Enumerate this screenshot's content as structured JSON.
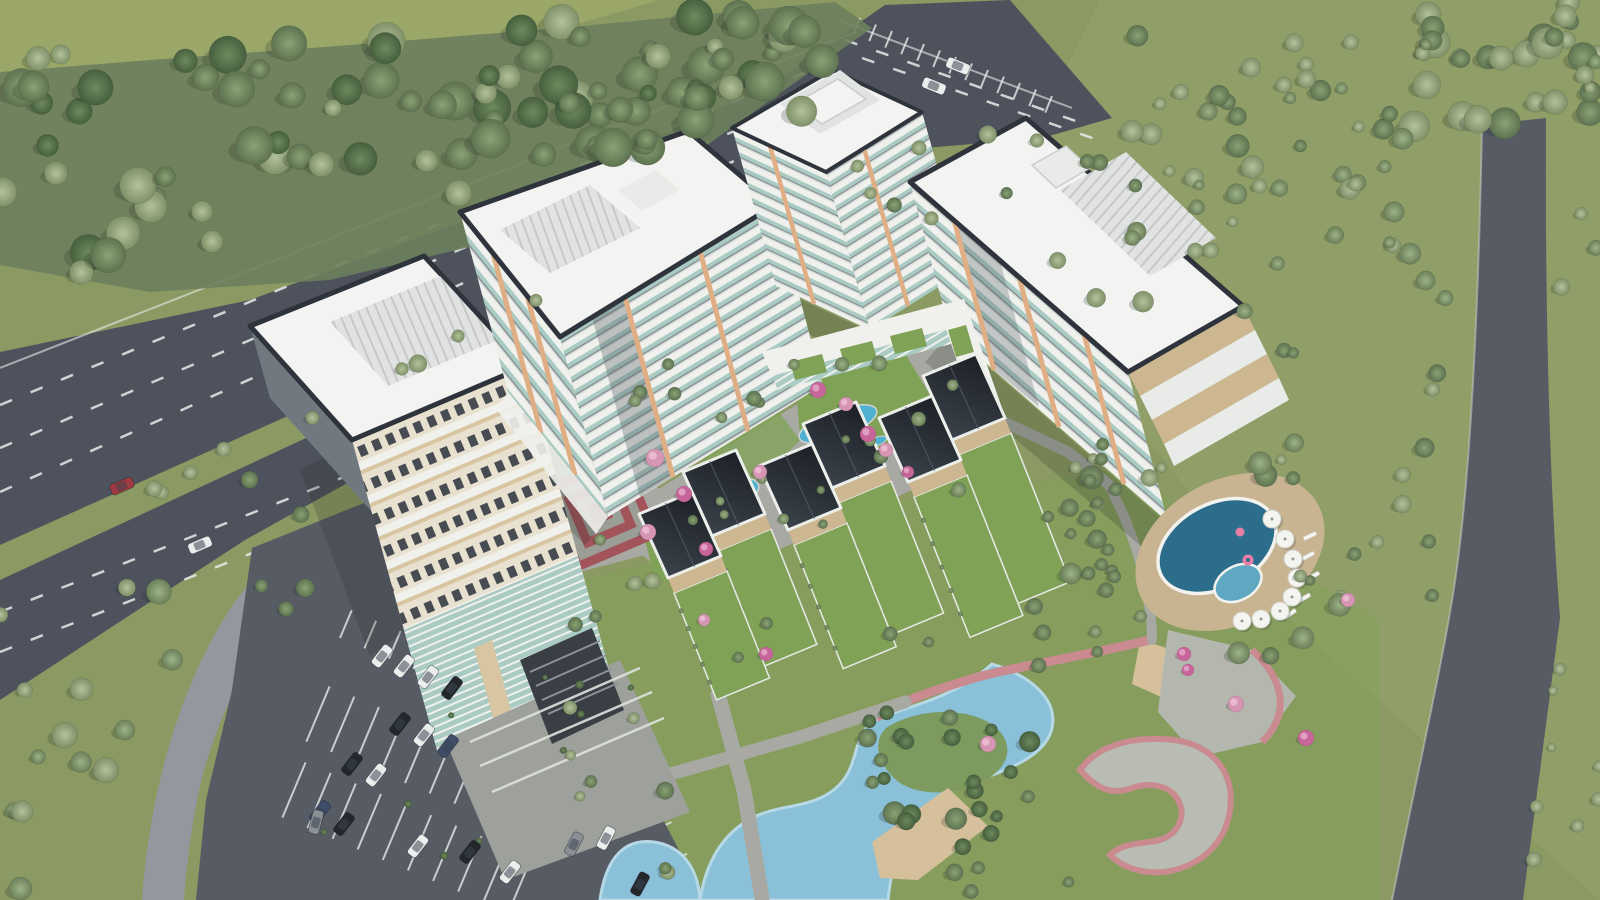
{
  "scene": {
    "description": "Aerial 3D architectural rendering of a residential complex: four white high-rise apartment towers with teal glass balconies and orange accents, a zigzag row of dark-roofed townhouses with private lawns, landscaped courtyards with blue ponds and pink flowering trees, a red-brick spiral plaza, an oval swimming pool with white umbrellas and pink floats, a winding lagoon with a sandy beach, dark asphalt roads and parking lots with cars, all surrounded by green fields and dense trees."
  },
  "palette": {
    "grass": "#8b9a62",
    "grassLight": "#9aa86e",
    "grassBright": "#7fa257",
    "grassField": "#9aa768",
    "rightTint": "#95a26c",
    "forestUnder": "#6d7f5d",
    "asphalt": "#4d525c",
    "asphaltLight": "#565b64",
    "roadCurve": "#94979e",
    "laneWhite": "#e8eae8",
    "concrete": "#a8a9a3",
    "concreteLight": "#c2c3bd",
    "plazaGray": "#9da09b",
    "roofWhite": "#f3f4f1",
    "roofShade": "#e9ebe8",
    "roofTrim": "#2e333c",
    "equip": "#e1e3e2",
    "equipRib": "#c6c9c8",
    "facadeCream": "#e9e1cf",
    "facadeWhite": "#f0f1ed",
    "facadeTan": "#d8c5a2",
    "accent": "#e0ae85",
    "glassTeal": "#a9cbc3",
    "glassDark": "#474c52",
    "facadeGray": "#707880",
    "stripeGray": "#8a9296",
    "stripeShade": "#dde1de",
    "townRoofA": "#23272d",
    "townRoofB": "#434a53",
    "deckTan": "#cdb791",
    "poolDeep": "#2d6d8c",
    "poolShallow": "#5fa8c2",
    "pondBlue": "#4fb0cf",
    "pondLight": "#8ed2e3",
    "lagoon": "#8ac0d8",
    "lagoonLight": "#aed4e4",
    "sand": "#d6c09c",
    "pathPink": "#c98b90",
    "plazaRed": "#a2545a",
    "plazaRing": "#9b9e97",
    "flowerPink": "#d795b4",
    "flowerMagenta": "#c7659a",
    "umbrella": "#f4f4f0",
    "shadow": "rgba(35,45,35,0.22)",
    "carWhite": "#eceeee",
    "carBlack": "#23262b",
    "carGray": "#8b8f96",
    "carBlue": "#3d4d6a",
    "carRed": "#a23840"
  }
}
